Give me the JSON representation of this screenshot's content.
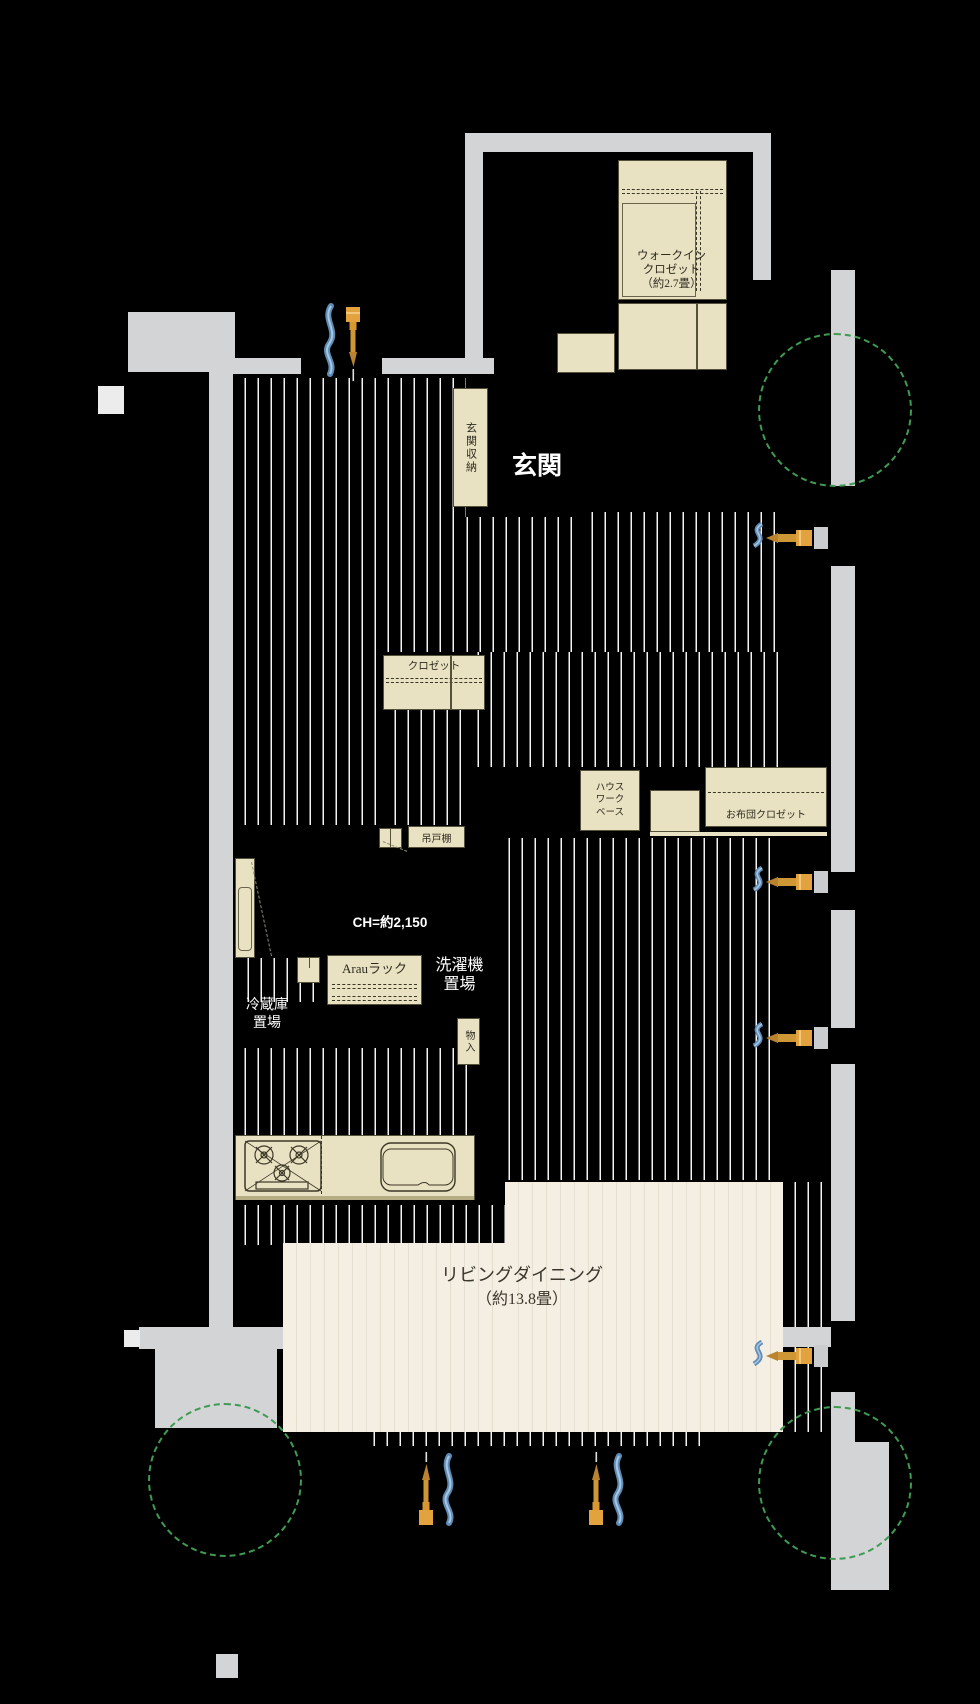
{
  "plan": {
    "title": "floor-plan",
    "labels": {
      "walk_in_closet_lines": [
        "ウォークイン",
        "クロゼット",
        "（約2.7畳）"
      ],
      "entrance": "玄関",
      "entrance_storage": "玄関収納",
      "closet": "クロゼット",
      "housework_lines": [
        "ハウス",
        "ワーク",
        "ベース"
      ],
      "futon_closet": "お布団クロゼット",
      "hanging_cupboard": "吊戸棚",
      "arau_rack": "Arauラック",
      "washer_lines": [
        "洗濯機",
        "置場"
      ],
      "storage": "物入",
      "fridge_lines": [
        "冷蔵庫",
        "置場"
      ],
      "ceiling_height": "CH=約2,150",
      "living_dining_lines": [
        "リビングダイニング",
        "（約13.8畳）"
      ]
    },
    "icons": [
      "faucet-icon",
      "hot-water-wave-icon",
      "green-dashed-circle"
    ],
    "colors": {
      "background": "#000000",
      "wall_gray": "#d3d4d6",
      "floor_box_cream": "#e9e2c2",
      "living_floor_cream": "#f5efe3",
      "stripe_white": "#f4f4f4",
      "outline_olive": "#55503a",
      "green_circle": "#3f9b52",
      "wave_blue": "#5d8cb8",
      "faucet_orange": "#e2a33f",
      "white_text": "#ffffff"
    }
  }
}
